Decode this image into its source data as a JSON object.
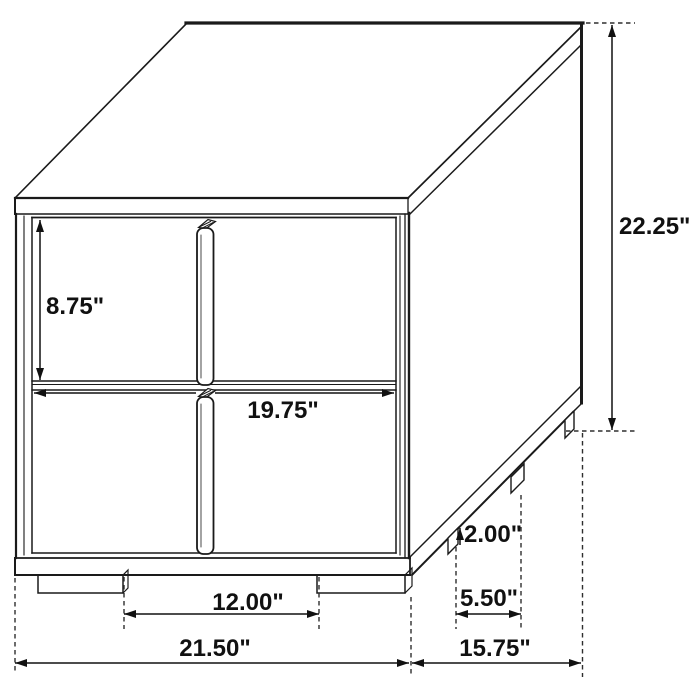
{
  "figure": {
    "description": "Isometric line drawing of a two-drawer nightstand with dimension annotations",
    "unit": "inches",
    "colors": {
      "line": "#1a1a1a",
      "background": "#ffffff"
    },
    "dimensions": {
      "drawer_height": {
        "label": "8.75\"",
        "value": 8.75
      },
      "overall_height": {
        "label": "22.25\"",
        "value": 22.25
      },
      "drawer_width": {
        "label": "19.75\"",
        "value": 19.75
      },
      "leg_height": {
        "label": "2.00\"",
        "value": 2.0
      },
      "side_leg_spacing": {
        "label": "5.50\"",
        "value": 5.5
      },
      "front_leg_spacing": {
        "label": "12.00\"",
        "value": 12.0
      },
      "overall_width": {
        "label": "21.50\"",
        "value": 21.5
      },
      "overall_depth": {
        "label": "15.75\"",
        "value": 15.75
      }
    }
  }
}
